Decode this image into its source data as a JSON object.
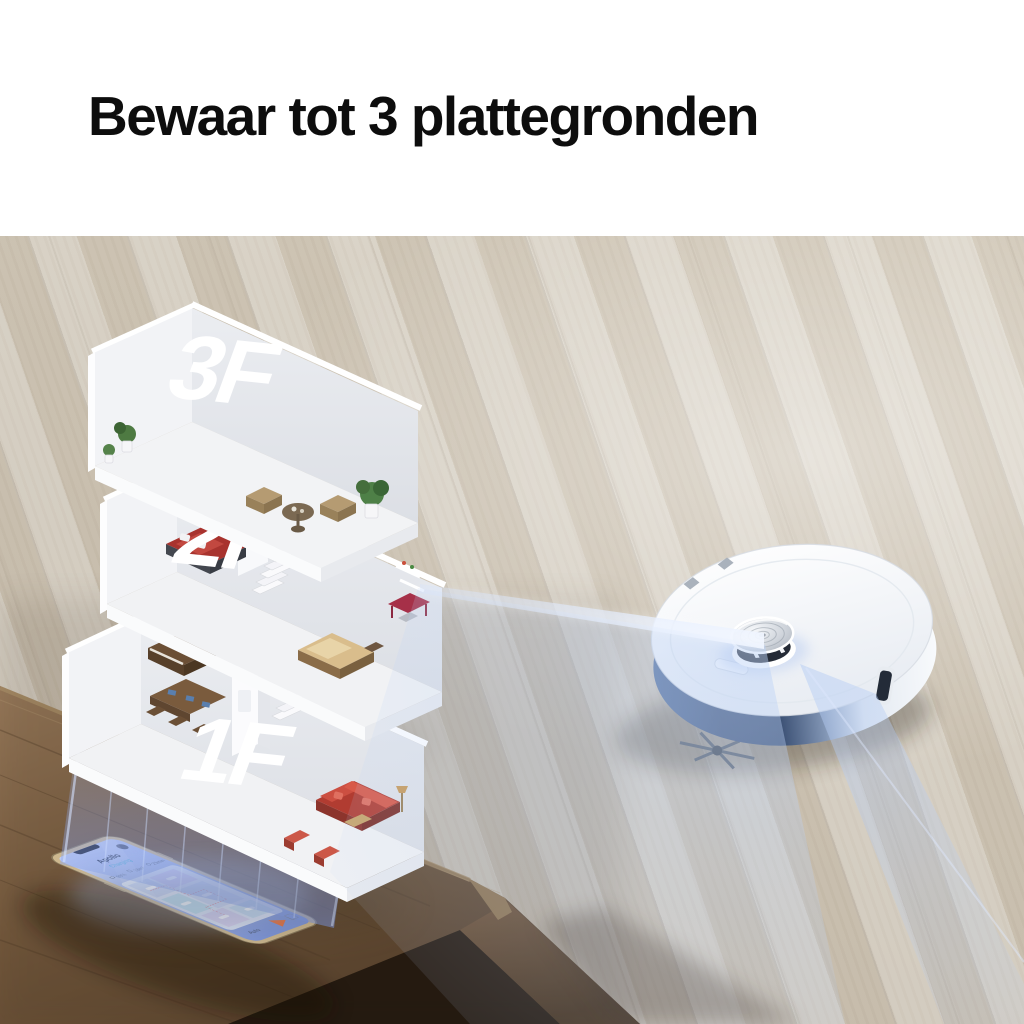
{
  "header": {
    "title": "Bewaar tot 3 plattegronden"
  },
  "floorplan": {
    "floors": [
      {
        "label": "3F"
      },
      {
        "label": "2F"
      },
      {
        "label": "1F"
      }
    ]
  },
  "phone": {
    "app": {
      "title": "Apollo",
      "status": "Charging",
      "stats": [
        {
          "value": "98%"
        },
        {
          "value": "18m²"
        },
        {
          "value": "23min"
        }
      ],
      "mode": "Auto"
    }
  },
  "icons": {
    "lidar": "lidar-turret",
    "start": "start-triangle"
  },
  "colors": {
    "title_text": "#0d0d0d",
    "floor_wood": "#ddd6c8",
    "table_wood": "#7d6244",
    "beam_blue": "#9db8e8",
    "robot_bumper": "#46618c",
    "sofa_red": "#cc4f41",
    "status_teal": "#35aed0",
    "start_orange": "#e87340"
  }
}
